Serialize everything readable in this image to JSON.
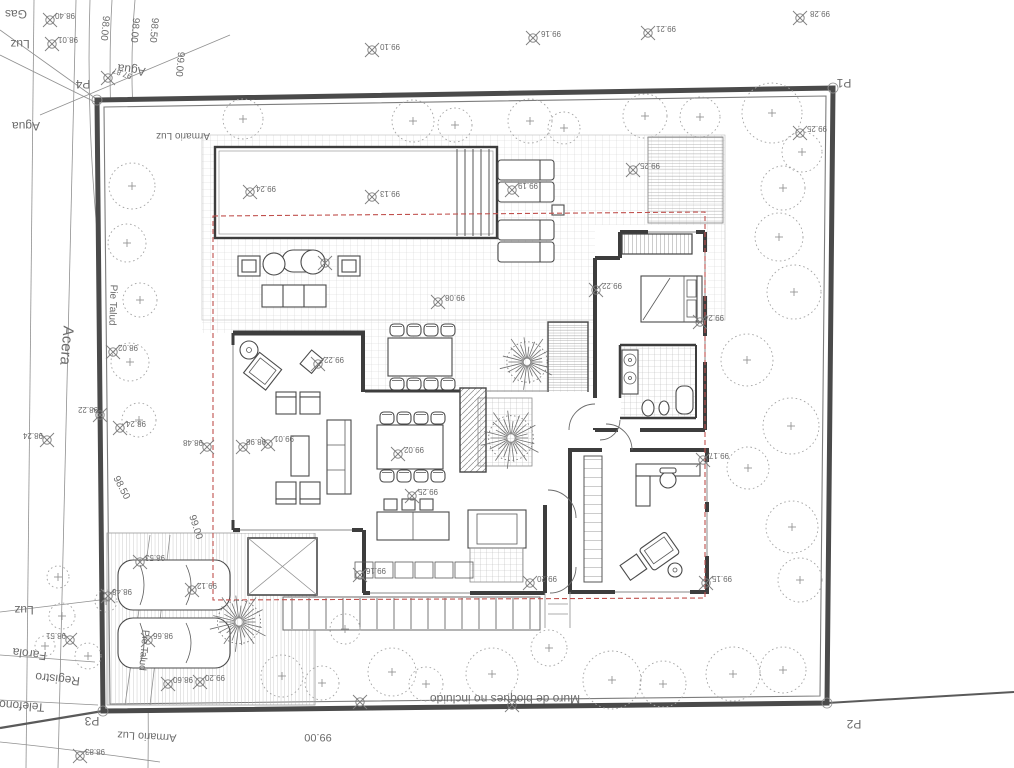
{
  "palette": {
    "paper": "#ffffff",
    "boundary": "#4a4a4a",
    "walls": "#3d3d3d",
    "hatch": "#c8c8c8",
    "trees": "#a3a3a3",
    "setback_red": "#c0504d",
    "survey_mark": "#7d7d7d",
    "label_text": "#6b6b6b"
  },
  "corner_points": [
    "P1",
    "P2",
    "P3",
    "P4"
  ],
  "labels": [
    {
      "t": "Gas",
      "x": 16,
      "y": 10,
      "r": 180,
      "s": 12,
      "k": "utility-label"
    },
    {
      "t": "Luz",
      "x": 20,
      "y": 40,
      "r": 180,
      "s": 12,
      "k": "utility-label"
    },
    {
      "t": "Agua",
      "x": 132,
      "y": 66,
      "r": 188,
      "s": 12,
      "k": "utility-label"
    },
    {
      "t": "Agua",
      "x": 26,
      "y": 122,
      "r": 180,
      "s": 12,
      "k": "utility-label"
    },
    {
      "t": "Acera",
      "x": 62,
      "y": 345,
      "r": 95,
      "s": 15,
      "k": "street-label"
    },
    {
      "t": "Pie Talud",
      "x": 110,
      "y": 305,
      "r": 92,
      "s": 10,
      "k": "terrain-label"
    },
    {
      "t": "Pie Talud",
      "x": 141,
      "y": 650,
      "r": 95,
      "s": 10,
      "k": "terrain-label"
    },
    {
      "t": "Luz",
      "x": 24,
      "y": 606,
      "r": 180,
      "s": 12,
      "k": "utility-label"
    },
    {
      "t": "Farola",
      "x": 30,
      "y": 650,
      "r": 187,
      "s": 12,
      "k": "utility-label"
    },
    {
      "t": "Registro",
      "x": 58,
      "y": 675,
      "r": 186,
      "s": 12,
      "k": "utility-label"
    },
    {
      "t": "Telefono",
      "x": 22,
      "y": 702,
      "r": 184,
      "s": 12,
      "k": "utility-label"
    },
    {
      "t": "Armario Luz",
      "x": 183,
      "y": 133,
      "r": 180,
      "s": 10,
      "k": "utility-label"
    },
    {
      "t": "Armario Luz",
      "x": 147,
      "y": 733,
      "r": 183,
      "s": 11,
      "k": "utility-label"
    },
    {
      "t": "Muro de bloques no incluido",
      "x": 505,
      "y": 695,
      "r": 180,
      "s": 12,
      "k": "wall-note-label"
    },
    {
      "t": "98.00",
      "x": 102,
      "y": 28,
      "r": 95,
      "s": 10,
      "k": "contour-label"
    },
    {
      "t": "98.00",
      "x": 132,
      "y": 30,
      "r": 95,
      "s": 10,
      "k": "contour-label"
    },
    {
      "t": "98.50",
      "x": 151,
      "y": 30,
      "r": 95,
      "s": 10,
      "k": "contour-label"
    },
    {
      "t": "99.00",
      "x": 177,
      "y": 64,
      "r": 95,
      "s": 10,
      "k": "contour-label"
    },
    {
      "t": "98.50",
      "x": 119,
      "y": 489,
      "r": 62,
      "s": 10,
      "k": "contour-label"
    },
    {
      "t": "99.00",
      "x": 193,
      "y": 528,
      "r": 72,
      "s": 10,
      "k": "contour-label"
    },
    {
      "t": "99.00",
      "x": 318,
      "y": 734,
      "r": 180,
      "s": 11,
      "k": "contour-label"
    },
    {
      "t": "P1",
      "x": 844,
      "y": 79,
      "r": 180,
      "s": 12,
      "k": "corner-point-label"
    },
    {
      "t": "P2",
      "x": 854,
      "y": 720,
      "r": 180,
      "s": 12,
      "k": "corner-point-label"
    },
    {
      "t": "P3",
      "x": 92,
      "y": 717,
      "r": 180,
      "s": 12,
      "k": "corner-point-label"
    },
    {
      "t": "P4",
      "x": 83,
      "y": 80,
      "r": 180,
      "s": 12,
      "k": "corner-point-label"
    },
    {
      "t": "98.40",
      "x": 65,
      "y": 13,
      "r": 180,
      "s": 8,
      "k": "elevation-label"
    },
    {
      "t": "98.01",
      "x": 68,
      "y": 37,
      "r": 180,
      "s": 8,
      "k": "elevation-label"
    },
    {
      "t": "97.87",
      "x": 123,
      "y": 71,
      "r": 200,
      "s": 8,
      "k": "elevation-label"
    },
    {
      "t": "99.10",
      "x": 390,
      "y": 44,
      "r": 180,
      "s": 8,
      "k": "elevation-label"
    },
    {
      "t": "99.16",
      "x": 551,
      "y": 31,
      "r": 180,
      "s": 8,
      "k": "elevation-label"
    },
    {
      "t": "99.21",
      "x": 666,
      "y": 26,
      "r": 180,
      "s": 8,
      "k": "elevation-label"
    },
    {
      "t": "99.28",
      "x": 820,
      "y": 11,
      "r": 180,
      "s": 8,
      "k": "elevation-label"
    },
    {
      "t": "99.24",
      "x": 266,
      "y": 186,
      "r": 180,
      "s": 8,
      "k": "elevation-label"
    },
    {
      "t": "99.13",
      "x": 390,
      "y": 191,
      "r": 180,
      "s": 8,
      "k": "elevation-label"
    },
    {
      "t": "99.19",
      "x": 528,
      "y": 183,
      "r": 180,
      "s": 8,
      "k": "elevation-label"
    },
    {
      "t": "99.25",
      "x": 650,
      "y": 163,
      "r": 180,
      "s": 8,
      "k": "elevation-label"
    },
    {
      "t": "99.25",
      "x": 817,
      "y": 126,
      "r": 180,
      "s": 8,
      "k": "elevation-label"
    },
    {
      "t": "99.08",
      "x": 455,
      "y": 295,
      "r": 180,
      "s": 8,
      "k": "elevation-label"
    },
    {
      "t": "99.22",
      "x": 334,
      "y": 357,
      "r": 180,
      "s": 8,
      "k": "elevation-label"
    },
    {
      "t": "98.48",
      "x": 193,
      "y": 440,
      "r": 180,
      "s": 8,
      "k": "elevation-label"
    },
    {
      "t": "98.98",
      "x": 256,
      "y": 439,
      "r": 180,
      "s": 8,
      "k": "elevation-label"
    },
    {
      "t": "99.01",
      "x": 284,
      "y": 436,
      "r": 180,
      "s": 8,
      "k": "elevation-label"
    },
    {
      "t": "99.02",
      "x": 414,
      "y": 447,
      "r": 180,
      "s": 8,
      "k": "elevation-label"
    },
    {
      "t": "99.25",
      "x": 428,
      "y": 489,
      "r": 180,
      "s": 8,
      "k": "elevation-label"
    },
    {
      "t": "99.16",
      "x": 376,
      "y": 568,
      "r": 180,
      "s": 8,
      "k": "elevation-label"
    },
    {
      "t": "99.20",
      "x": 547,
      "y": 576,
      "r": 180,
      "s": 8,
      "k": "elevation-label"
    },
    {
      "t": "99.22",
      "x": 612,
      "y": 283,
      "r": 180,
      "s": 8,
      "k": "elevation-label"
    },
    {
      "t": "99.24",
      "x": 714,
      "y": 315,
      "r": 180,
      "s": 8,
      "k": "elevation-label"
    },
    {
      "t": "99.17",
      "x": 719,
      "y": 453,
      "r": 180,
      "s": 8,
      "k": "elevation-label"
    },
    {
      "t": "99.15",
      "x": 722,
      "y": 576,
      "r": 180,
      "s": 8,
      "k": "elevation-label"
    },
    {
      "t": "98.02",
      "x": 128,
      "y": 345,
      "r": 180,
      "s": 8,
      "k": "elevation-label"
    },
    {
      "t": "98.22",
      "x": 88,
      "y": 407,
      "r": 180,
      "s": 8,
      "k": "elevation-label"
    },
    {
      "t": "98.24",
      "x": 136,
      "y": 421,
      "r": 180,
      "s": 8,
      "k": "elevation-label"
    },
    {
      "t": "98.24",
      "x": 33,
      "y": 433,
      "r": 180,
      "s": 8,
      "k": "elevation-label"
    },
    {
      "t": "98.53",
      "x": 155,
      "y": 555,
      "r": 180,
      "s": 8,
      "k": "elevation-label"
    },
    {
      "t": "99.12",
      "x": 207,
      "y": 583,
      "r": 180,
      "s": 8,
      "k": "elevation-label"
    },
    {
      "t": "98.48",
      "x": 122,
      "y": 589,
      "r": 180,
      "s": 8,
      "k": "elevation-label"
    },
    {
      "t": "98.51",
      "x": 56,
      "y": 633,
      "r": 180,
      "s": 8,
      "k": "elevation-label"
    },
    {
      "t": "98.66",
      "x": 163,
      "y": 633,
      "r": 180,
      "s": 8,
      "k": "elevation-label"
    },
    {
      "t": "98.60",
      "x": 183,
      "y": 677,
      "r": 180,
      "s": 8,
      "k": "elevation-label"
    },
    {
      "t": "99.20",
      "x": 215,
      "y": 675,
      "r": 180,
      "s": 8,
      "k": "elevation-label"
    },
    {
      "t": "98.83",
      "x": 95,
      "y": 749,
      "r": 180,
      "s": 8,
      "k": "elevation-label"
    }
  ],
  "marks": [
    [
      50,
      20
    ],
    [
      52,
      44
    ],
    [
      108,
      78
    ],
    [
      372,
      50
    ],
    [
      533,
      38
    ],
    [
      648,
      33
    ],
    [
      800,
      18
    ],
    [
      250,
      192
    ],
    [
      372,
      197
    ],
    [
      512,
      190
    ],
    [
      633,
      170
    ],
    [
      800,
      133
    ],
    [
      438,
      302
    ],
    [
      318,
      364
    ],
    [
      207,
      447
    ],
    [
      243,
      447
    ],
    [
      268,
      444
    ],
    [
      398,
      454
    ],
    [
      412,
      496
    ],
    [
      360,
      575
    ],
    [
      530,
      583
    ],
    [
      596,
      290
    ],
    [
      700,
      322
    ],
    [
      703,
      460
    ],
    [
      706,
      583
    ],
    [
      113,
      352
    ],
    [
      100,
      415
    ],
    [
      120,
      428
    ],
    [
      47,
      440
    ],
    [
      140,
      562
    ],
    [
      192,
      590
    ],
    [
      108,
      596
    ],
    [
      70,
      640
    ],
    [
      148,
      640
    ],
    [
      168,
      684
    ],
    [
      200,
      682
    ],
    [
      80,
      756
    ],
    [
      360,
      702
    ],
    [
      512,
      705
    ],
    [
      325,
      263
    ]
  ]
}
